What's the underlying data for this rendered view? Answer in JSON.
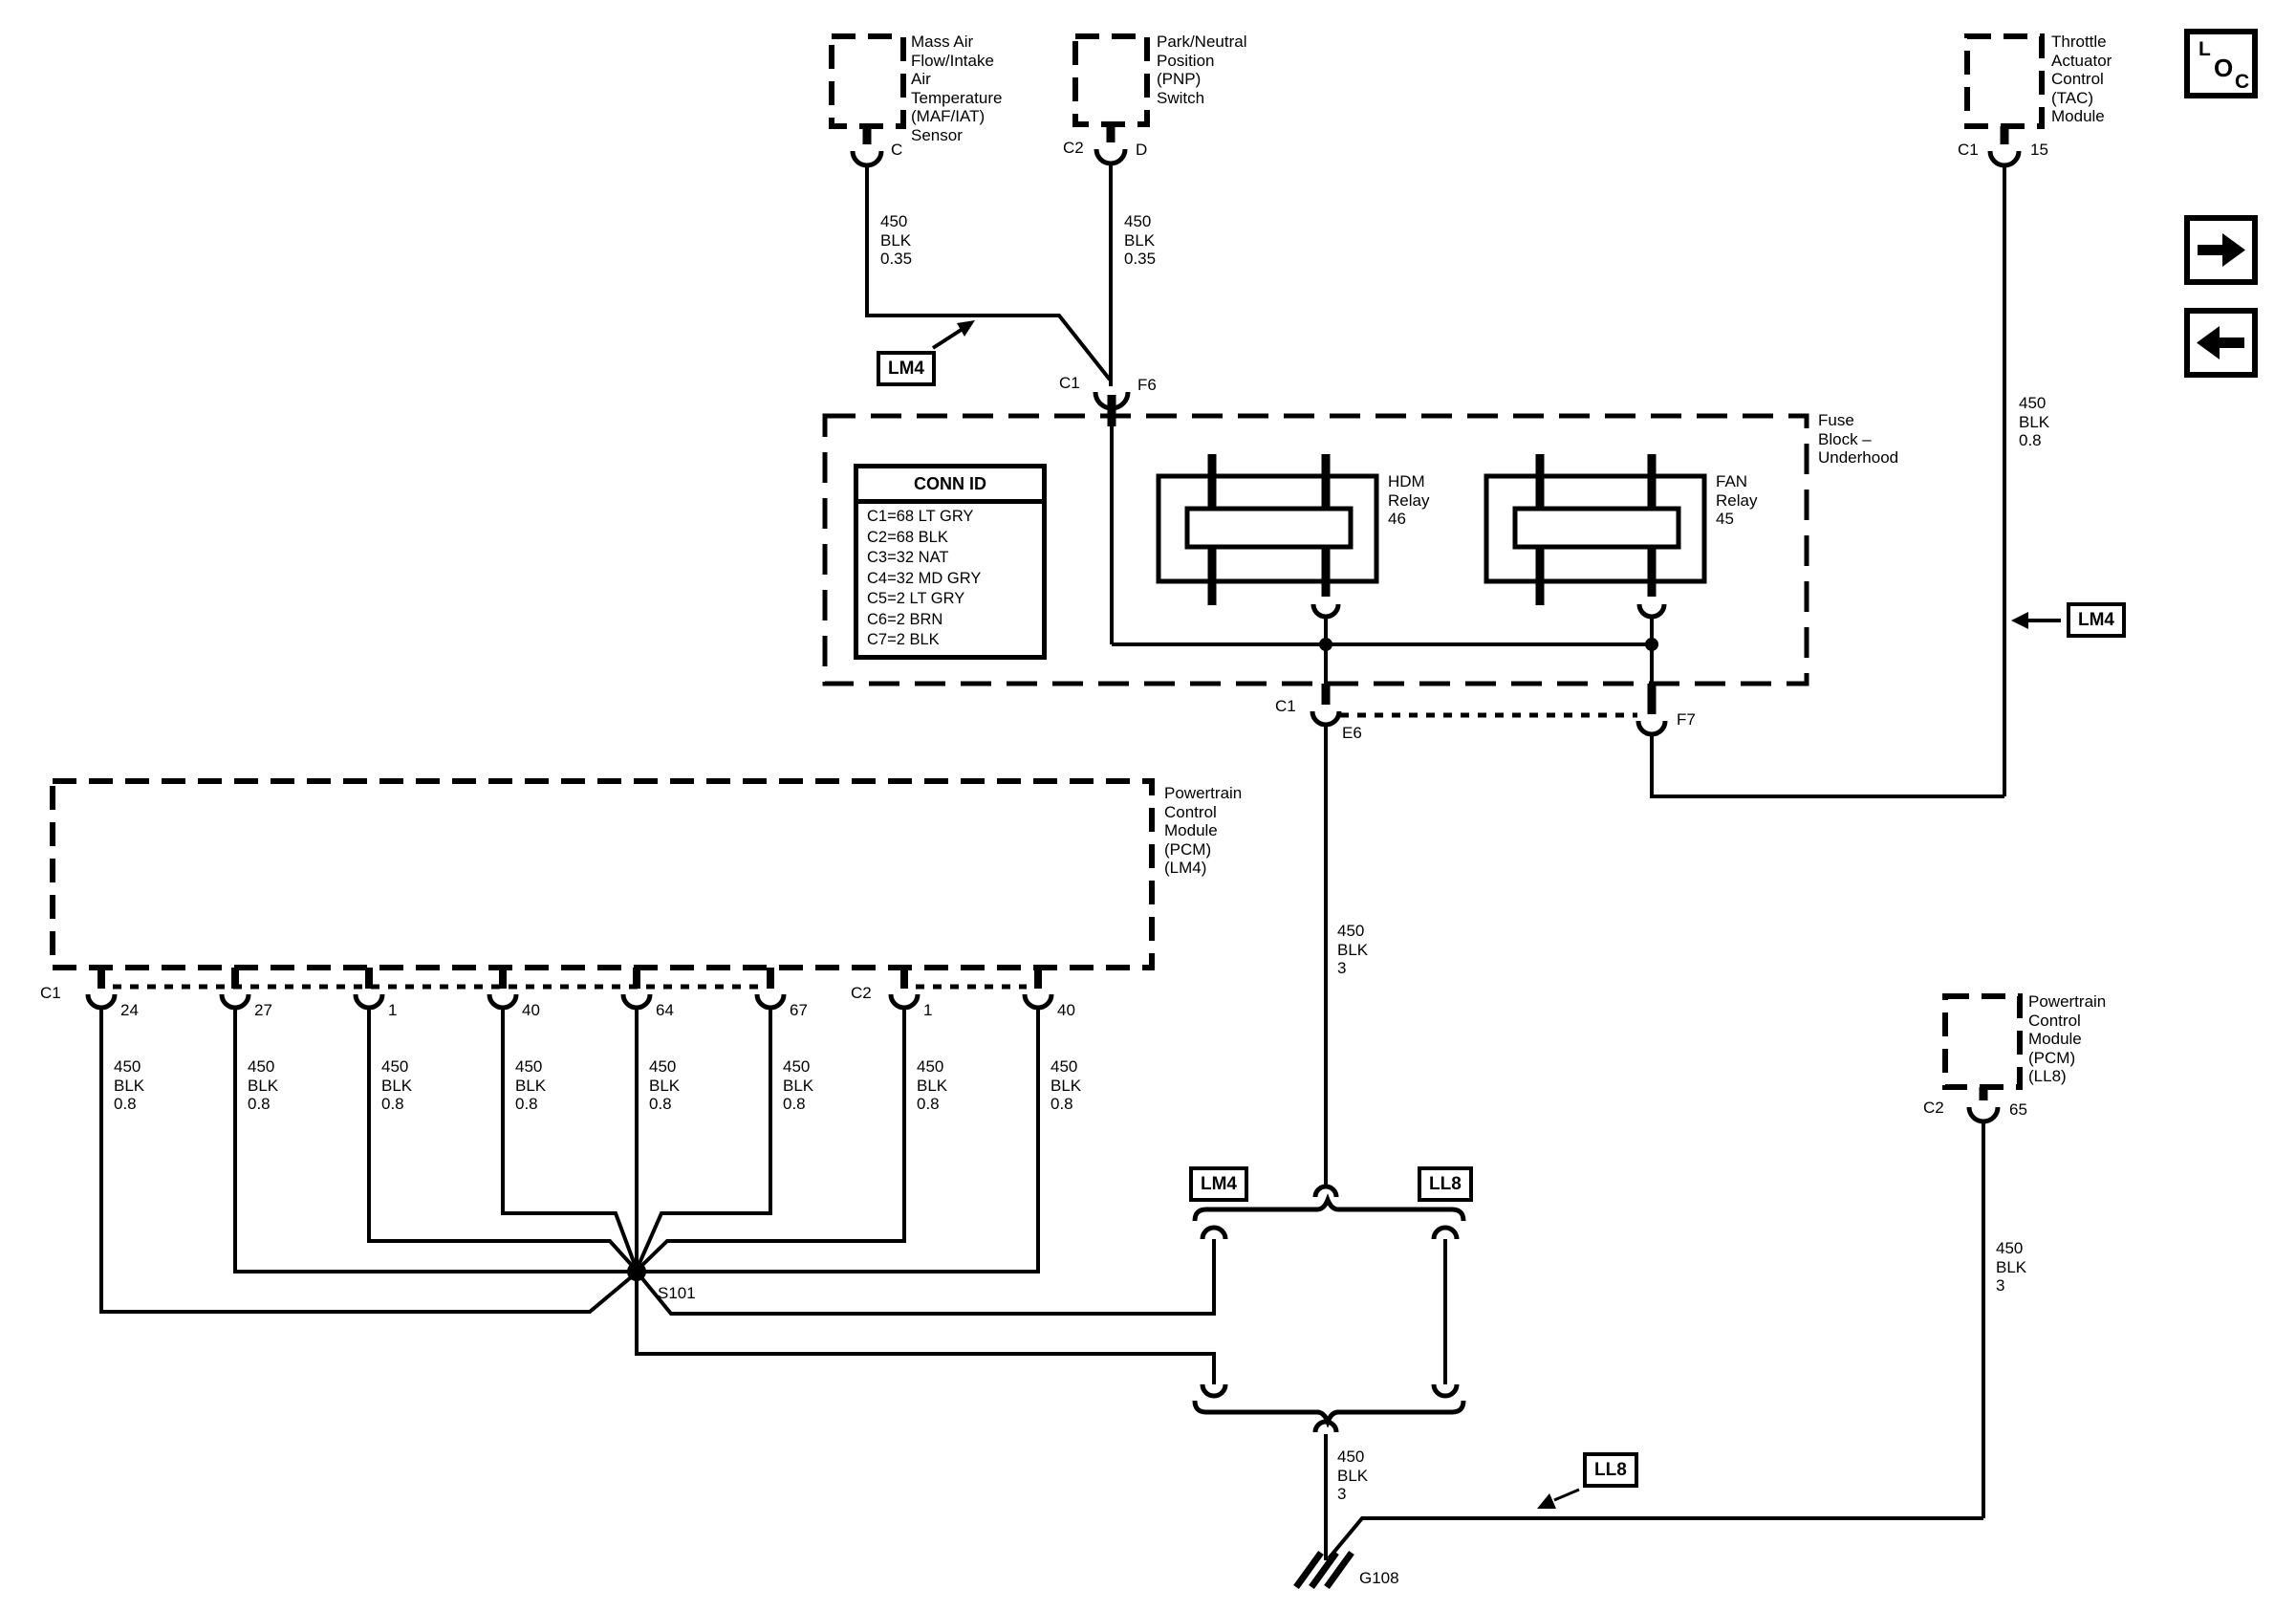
{
  "colors": {
    "ink": "#000000",
    "paper": "#ffffff"
  },
  "components": {
    "maf_sensor": {
      "name": "Mass Air\nFlow/Intake\nAir\nTemperature\n(MAF/IAT)\nSensor",
      "pin": "C"
    },
    "pnp_switch": {
      "name": "Park/Neutral\nPosition\n(PNP)\nSwitch",
      "conn": "C2",
      "pin": "D"
    },
    "tac_module": {
      "name": "Throttle\nActuator\nControl\n(TAC)\nModule",
      "conn": "C1",
      "pin": "15"
    },
    "fuse_block": {
      "name": "Fuse\nBlock –\nUnderhood"
    },
    "hdm_relay": {
      "name": "HDM\nRelay\n46"
    },
    "fan_relay": {
      "name": "FAN\nRelay\n45"
    },
    "pcm_ll8": {
      "name": "Powertrain\nControl\nModule\n(PCM)\n(LL8)",
      "conn": "C2",
      "pin": "65"
    }
  },
  "conn_id_table": {
    "title": "CONN ID",
    "rows": [
      "C1=68 LT GRY",
      "C2=68 BLK",
      "C3=32 NAT",
      "C4=32 MD GRY",
      "C5=2 LT GRY",
      "C6=2 BRN",
      "C7=2 BLK"
    ]
  },
  "connectors": {
    "f6": {
      "conn": "C1",
      "pin": "F6"
    },
    "e6": {
      "conn": "C1",
      "pin": "E6"
    },
    "f7": {
      "pin": "F7"
    }
  },
  "wires": {
    "maf": "450\nBLK\n0.35",
    "pnp": "450\nBLK\n0.35",
    "tac": "450\nBLK\n0.8",
    "e6_drop": "450\nBLK\n3",
    "ground_drop": "450\nBLK\n3",
    "ll8_drop": "450\nBLK\n3"
  },
  "pcm_lm4": {
    "name": "Powertrain\nControl\nModule\n(PCM)\n(LM4)",
    "c1_label": "C1",
    "c2_label": "C2",
    "pins": [
      {
        "n": "24",
        "wire": "450\nBLK\n0.8"
      },
      {
        "n": "27",
        "wire": "450\nBLK\n0.8"
      },
      {
        "n": "1",
        "wire": "450\nBLK\n0.8"
      },
      {
        "n": "40",
        "wire": "450\nBLK\n0.8"
      },
      {
        "n": "64",
        "wire": "450\nBLK\n0.8"
      },
      {
        "n": "67",
        "wire": "450\nBLK\n0.8"
      },
      {
        "n": "1",
        "wire": "450\nBLK\n0.8"
      },
      {
        "n": "40",
        "wire": "450\nBLK\n0.8"
      }
    ]
  },
  "splice": {
    "label": "S101"
  },
  "ground": {
    "label": "G108"
  },
  "tags": {
    "lm4_top": "LM4",
    "lm4_right": "LM4",
    "junction_lm4": "LM4",
    "junction_ll8": "LL8",
    "ll8_bottom": "LL8"
  },
  "nav": {
    "loc": [
      "L",
      "O",
      "C"
    ]
  }
}
